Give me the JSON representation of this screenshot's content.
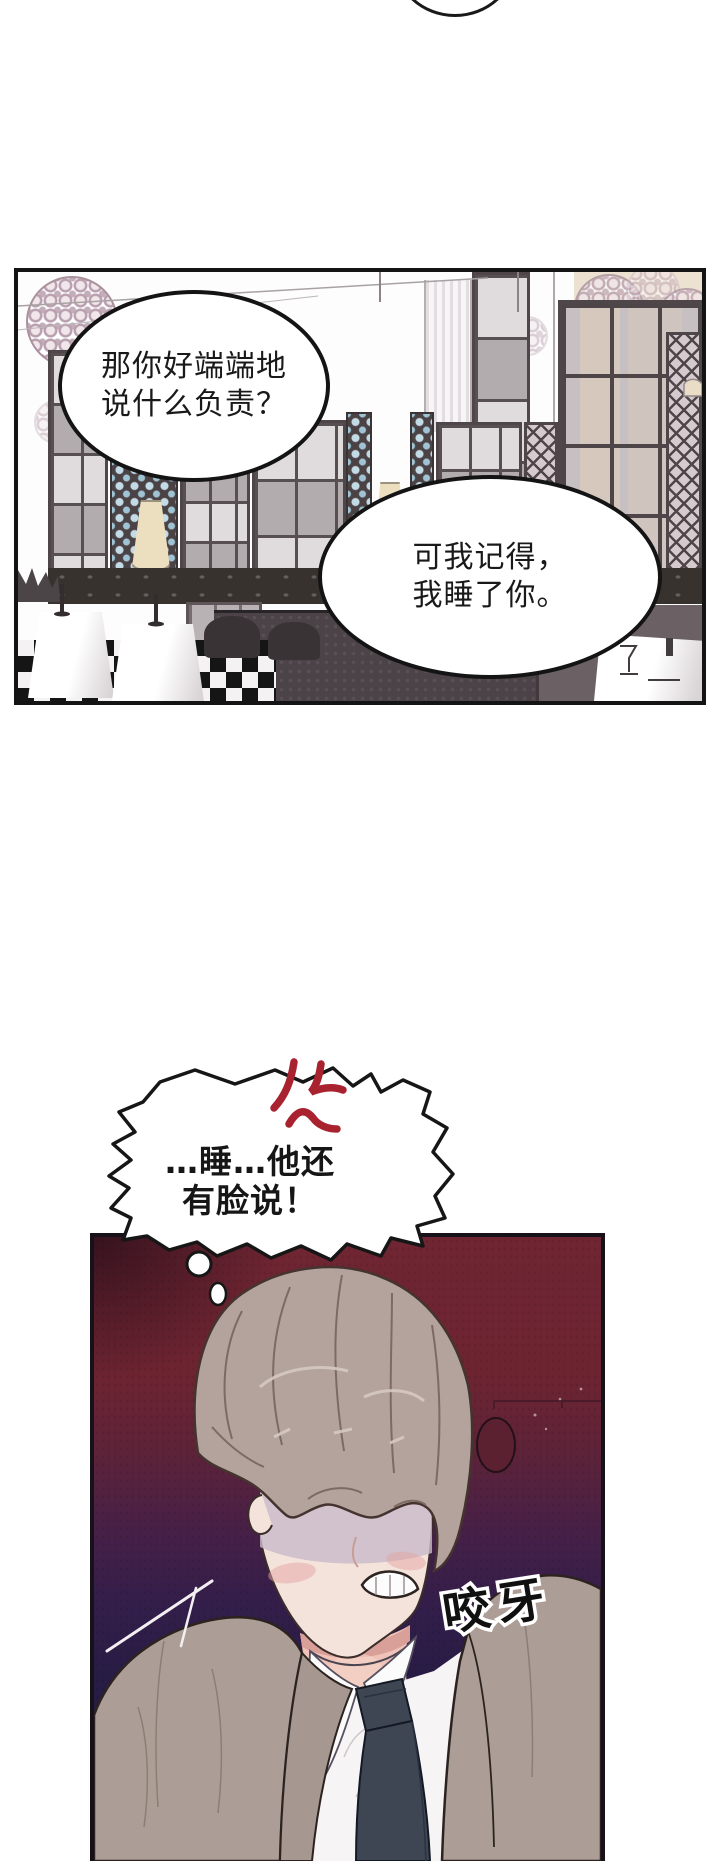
{
  "panel1": {
    "bubble1": {
      "line1": "那你好端端地",
      "line2": "说什么负责？"
    },
    "bubble2": {
      "line1": "可我记得，",
      "line2": "我睡了你。"
    }
  },
  "thought_bubble": {
    "line1": "…睡…他还",
    "line2": "有脸说！"
  },
  "panel2": {
    "sfx": "咬牙"
  },
  "colors": {
    "panel_border": "#141414",
    "maroon_bg": "#6e2431",
    "purple_bg": "#261c43",
    "anger_red": "#a8222f",
    "hair": "#b3a39c",
    "skin": "#f4e3db",
    "blush": "#e4a3a1",
    "suit": "#ac9e96",
    "tie": "#3e4654",
    "shirt": "#f7f4f5",
    "lamp_cream": "#ebdfc0",
    "honeycomb_blue": "#c2dbe6"
  },
  "icons": {
    "anger_mark": "red anger-vein mark",
    "thought_trail": "small thought bubbles"
  }
}
